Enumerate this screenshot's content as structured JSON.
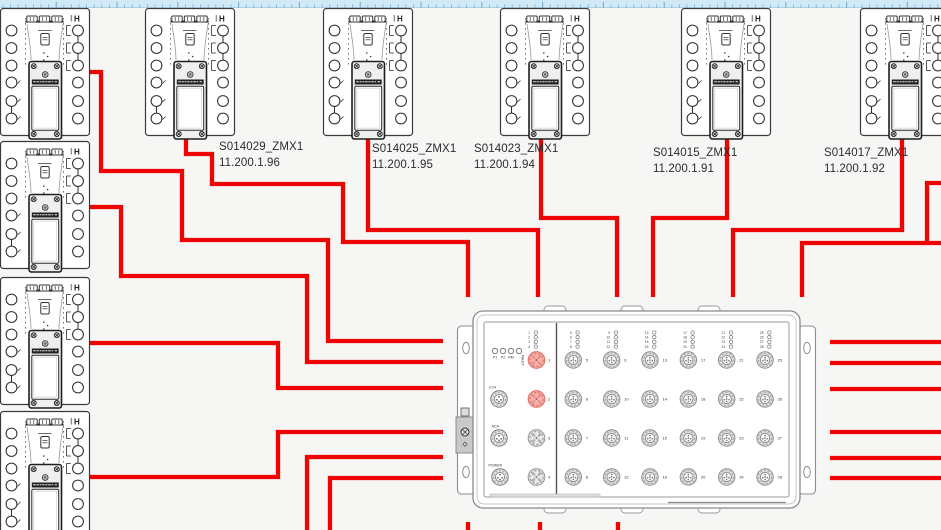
{
  "canvas": {
    "width": 941,
    "height": 530,
    "background": "#f6f6f5"
  },
  "ruler": {
    "height": 7,
    "bg": "#cfe9f7",
    "tick_color": "#7aa7c5",
    "edge_color": "#aed2e6",
    "minor_spacing": 7.6,
    "major_every": 8
  },
  "colors": {
    "wire": "#ee0400",
    "device_outline": "#3a3a3a",
    "switch_outline": "#8a8a8a",
    "label_text": "#2c2c2c",
    "port_red_fill": "#f6b5b0",
    "port_red_stroke": "#df7168",
    "port_gray_fill": "#e4e4e4",
    "port_gray_stroke": "#8d8d8d"
  },
  "devices": {
    "glyph": "ZMX1-module",
    "left_column": [
      {
        "x": 0,
        "y": 8
      },
      {
        "x": 0,
        "y": 141
      },
      {
        "x": 0,
        "y": 277
      },
      {
        "x": 0,
        "y": 411
      }
    ],
    "top_row": [
      {
        "x": 145,
        "y": 8,
        "name": "S014029_ZMX1",
        "ip": "11.200.1.96",
        "label_x": 219,
        "label_y": 139
      },
      {
        "x": 323,
        "y": 8,
        "name": "S014025_ZMX1",
        "ip": "11.200.1.95",
        "label_x": 372,
        "label_y": 141
      },
      {
        "x": 500,
        "y": 8,
        "name": "S014023_ZMX1",
        "ip": "11.200.1.94",
        "label_x": 474,
        "label_y": 141
      },
      {
        "x": 681,
        "y": 8,
        "name": "S014015_ZMX1",
        "ip": "11.200.1.91",
        "label_x": 653,
        "label_y": 145
      },
      {
        "x": 860,
        "y": 8,
        "name": "S014017_ZMX1",
        "ip": "11.200.1.92",
        "label_x": 824,
        "label_y": 145
      }
    ],
    "corner_mark": "H"
  },
  "switch": {
    "x": 473,
    "y": 311,
    "width": 327,
    "height": 197,
    "status_leds": [
      "P1",
      "P2",
      "RM",
      "FAULT"
    ],
    "service_ports": [
      "V.24",
      "ACA",
      "POWER"
    ],
    "highlighted_ports": [
      1,
      2
    ],
    "port_columns": [
      [
        1,
        2,
        3,
        4
      ],
      [
        5,
        6,
        7,
        8
      ],
      [
        9,
        10,
        11,
        12
      ],
      [
        13,
        14,
        15,
        16
      ],
      [
        17,
        18,
        19,
        20
      ],
      [
        21,
        22,
        23,
        24
      ],
      [
        25,
        26,
        27,
        28
      ]
    ]
  },
  "wires": [
    {
      "points": [
        [
          86,
          72
        ],
        [
          101,
          72
        ],
        [
          101,
          171
        ],
        [
          182,
          171
        ],
        [
          182,
          240
        ],
        [
          328,
          240
        ],
        [
          328,
          341
        ],
        [
          443,
          341
        ]
      ]
    },
    {
      "points": [
        [
          86,
          207
        ],
        [
          121,
          207
        ],
        [
          121,
          276
        ],
        [
          307,
          276
        ],
        [
          307,
          362
        ],
        [
          443,
          362
        ]
      ]
    },
    {
      "points": [
        [
          86,
          343
        ],
        [
          278,
          343
        ],
        [
          278,
          388
        ],
        [
          443,
          388
        ]
      ]
    },
    {
      "points": [
        [
          86,
          477
        ],
        [
          278,
          477
        ],
        [
          278,
          432
        ],
        [
          443,
          432
        ]
      ]
    },
    {
      "points": [
        [
          307,
          531
        ],
        [
          307,
          457
        ],
        [
          443,
          457
        ]
      ]
    },
    {
      "points": [
        [
          330,
          531
        ],
        [
          330,
          478
        ],
        [
          443,
          478
        ]
      ]
    },
    {
      "points": [
        [
          186,
          139
        ],
        [
          186,
          154
        ],
        [
          212,
          154
        ],
        [
          212,
          184
        ],
        [
          343,
          184
        ],
        [
          343,
          242
        ],
        [
          468,
          242
        ],
        [
          468,
          297
        ]
      ]
    },
    {
      "points": [
        [
          368,
          139
        ],
        [
          368,
          230
        ],
        [
          538,
          230
        ],
        [
          538,
          297
        ]
      ]
    },
    {
      "points": [
        [
          541,
          139
        ],
        [
          541,
          218
        ],
        [
          617,
          218
        ],
        [
          617,
          297
        ]
      ]
    },
    {
      "points": [
        [
          727,
          139
        ],
        [
          727,
          218
        ],
        [
          653,
          218
        ],
        [
          653,
          297
        ]
      ]
    },
    {
      "points": [
        [
          902,
          139
        ],
        [
          902,
          230
        ],
        [
          733,
          230
        ],
        [
          733,
          297
        ]
      ]
    },
    {
      "points": [
        [
          942,
          183
        ],
        [
          927,
          183
        ],
        [
          927,
          243
        ]
      ]
    },
    {
      "points": [
        [
          942,
          243
        ],
        [
          802,
          243
        ],
        [
          802,
          297
        ]
      ]
    },
    {
      "points": [
        [
          468,
          522
        ],
        [
          468,
          531
        ]
      ]
    },
    {
      "points": [
        [
          540,
          522
        ],
        [
          540,
          531
        ]
      ]
    },
    {
      "points": [
        [
          618,
          522
        ],
        [
          618,
          531
        ]
      ]
    },
    {
      "points": [
        [
          830,
          342
        ],
        [
          942,
          342
        ]
      ]
    },
    {
      "points": [
        [
          830,
          363
        ],
        [
          942,
          363
        ]
      ]
    },
    {
      "points": [
        [
          830,
          389
        ],
        [
          942,
          389
        ]
      ]
    },
    {
      "points": [
        [
          830,
          432
        ],
        [
          942,
          432
        ]
      ]
    },
    {
      "points": [
        [
          830,
          458
        ],
        [
          942,
          458
        ]
      ]
    },
    {
      "points": [
        [
          830,
          478
        ],
        [
          942,
          478
        ]
      ]
    }
  ]
}
